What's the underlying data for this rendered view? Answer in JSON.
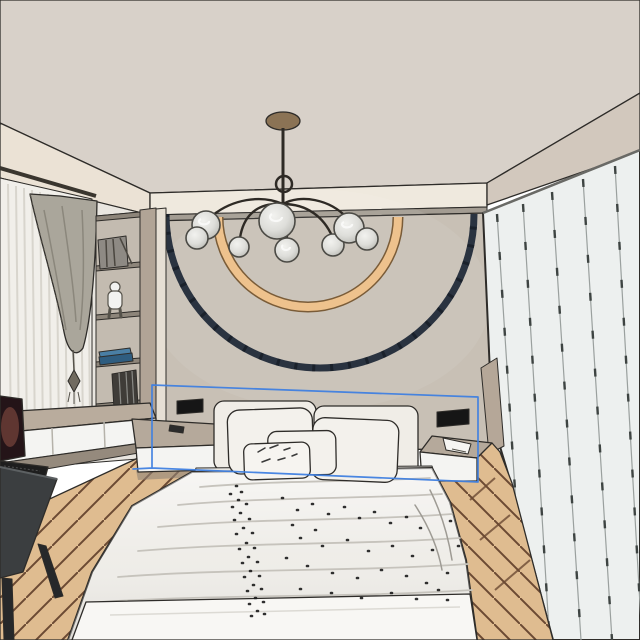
{
  "scene": {
    "type": "3d-interior-render",
    "room": "bedroom",
    "objects": [
      {
        "name": "ceiling"
      },
      {
        "name": "cove-molding-left"
      },
      {
        "name": "soffit"
      },
      {
        "name": "cove-molding-right"
      },
      {
        "name": "back-wall"
      },
      {
        "name": "decor-arc-outer"
      },
      {
        "name": "decor-arc-inner"
      },
      {
        "name": "chandelier"
      },
      {
        "name": "curtains"
      },
      {
        "name": "shelf-unit"
      },
      {
        "name": "desk"
      },
      {
        "name": "laptop"
      },
      {
        "name": "chair"
      },
      {
        "name": "floor"
      },
      {
        "name": "bed"
      },
      {
        "name": "headboard"
      },
      {
        "name": "pillows"
      },
      {
        "name": "duvet"
      },
      {
        "name": "nightstand-left"
      },
      {
        "name": "nightstand-right"
      },
      {
        "name": "wall-niche-left"
      },
      {
        "name": "wall-niche-right"
      },
      {
        "name": "wardrobe"
      },
      {
        "name": "selection-box"
      }
    ]
  },
  "selection": {
    "active": true,
    "color": "#3f7fe0"
  },
  "colors": {
    "ceiling": "#d8d1c9",
    "cove_left": "#ebe2d5",
    "soffit": "#efe9de",
    "cove_right": "#d2c8bd",
    "wall_reveal": "#a39c92",
    "wall": "#c8c0b5",
    "left_wall": "#e9e6e0",
    "wardrobe": "#edf0ef",
    "wardrobe_return": "#b5a798",
    "floor": "#dfbc90",
    "floor_line": "#6b4a33",
    "desk_top": "#b9ac9d",
    "drawer_front": "#f4f4f2",
    "desk_base": "#958a7d",
    "chair": "#3b3e40",
    "chair_leg": "#26282a",
    "laptop_screen": "#241418",
    "laptop_keyboard": "#1e1e1e",
    "headboard": "#f0ede7",
    "mattress": "#e8e6e1",
    "pillow": "#f3f1ec",
    "pillow_front": "#f6f4f0",
    "duvet": "#edebe6",
    "sheet": "#f8f7f4",
    "nightstand_top": "#b5a99b",
    "nightstand_front": "#f4f4f2",
    "niche": "#161616",
    "arc_outer": "#2a3340",
    "arc_inner": "#eec28d",
    "arc_inner_edge": "#7a5c38",
    "chandelier_metal": "#2e2a25",
    "chandelier_canopy": "#8b7355",
    "curtain_sheer": "#f1efea",
    "curtain_drape": "#aaa69b",
    "shelf_bg": "#c3bbb0",
    "shelf_panel": "#b1a496",
    "pilaster": "#e6dfd4",
    "shelf_board": "#8d857a",
    "book_blue": "#4a7fa5",
    "book_dark": "#3f3c38",
    "phone": "#2b2b2b",
    "tassel": "#716b60"
  }
}
